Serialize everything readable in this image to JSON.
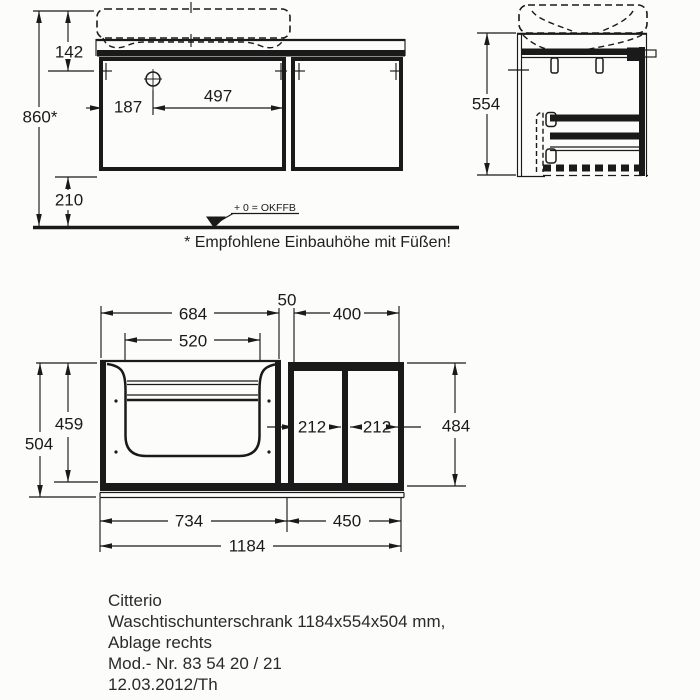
{
  "front_view": {
    "dim_top_offset": "142",
    "dim_install_height": "860*",
    "dim_tap_from_left": "187",
    "dim_tap_to_divider": "497",
    "dim_floor_clearance": "210",
    "datum_label": "+ 0 = OKFFB"
  },
  "side_view": {
    "dim_height": "554"
  },
  "plan_view": {
    "dim_left_section_width": "684",
    "dim_cutout_width": "520",
    "dim_gap": "50",
    "dim_right_section_width": "400",
    "dim_inner_depth": "459",
    "dim_total_depth": "504",
    "dim_compartment_left": "212",
    "dim_compartment_right": "212",
    "dim_shelf_depth": "484",
    "dim_left_bottom": "734",
    "dim_right_bottom": "450",
    "dim_total_width": "1184"
  },
  "footnote": "* Empfohlene Einbauhöhe mit Füßen!",
  "title_block": {
    "brand": "Citterio",
    "description": "Waschtischunterschrank 1184x554x504 mm,",
    "variant": "Ablage rechts",
    "model": "Mod.- Nr. 83 54 20 / 21",
    "date_ref": "12.03.2012/Th"
  },
  "colors": {
    "line": "#1a1a1a",
    "paper": "#fcfcfb",
    "text": "#2a2a2a"
  }
}
